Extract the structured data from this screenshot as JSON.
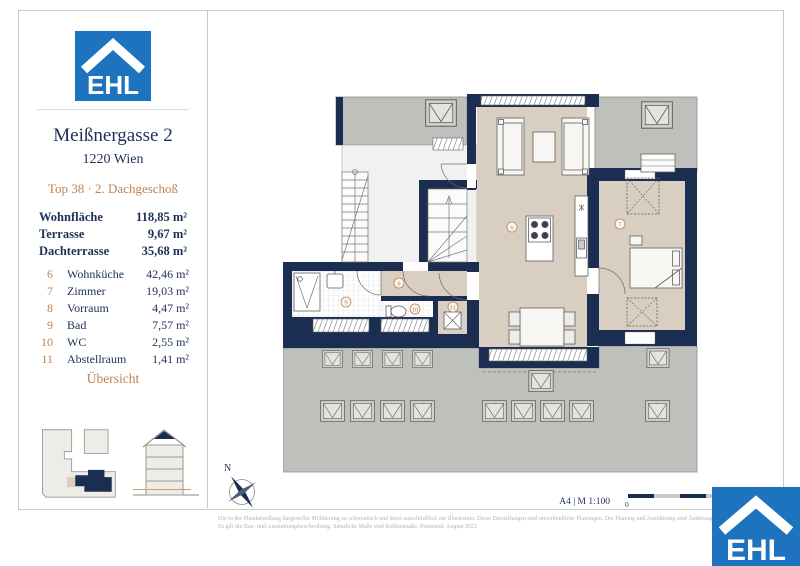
{
  "brand": {
    "name": "EHL",
    "blue": "#1e73be"
  },
  "sidebar": {
    "address_line1": "Meißnergasse 2",
    "address_line2": "1220 Wien",
    "unit_line": "Top 38 · 2. Dachgeschoß",
    "areas": [
      {
        "label": "Wohnfläche",
        "value": "118,85 m²"
      },
      {
        "label": "Terrasse",
        "value": "9,67 m²"
      },
      {
        "label": "Dachterrasse",
        "value": "35,68 m²"
      }
    ],
    "overview_title": "Übersicht"
  },
  "rooms": [
    {
      "no": "6",
      "name": "Wohnküche",
      "area": "42,46 m²"
    },
    {
      "no": "7",
      "name": "Zimmer",
      "area": "19,03 m²"
    },
    {
      "no": "8",
      "name": "Vorraum",
      "area": "4,47 m²"
    },
    {
      "no": "9",
      "name": "Bad",
      "area": "7,57 m²"
    },
    {
      "no": "10",
      "name": "WC",
      "area": "2,55 m²"
    },
    {
      "no": "11",
      "name": "Abstellraum",
      "area": "1,41 m²"
    }
  ],
  "footer": {
    "compass_label": "N",
    "format_scale": "A4 | M 1:100",
    "scale_zero": "0",
    "disclaimer_line1": "Die in der Plandarstellung dargestellte Möblierung ist schematisch und dient ausschließlich zur Illustration. Diese Darstellungen sind unverbindliche Planungen. Der Planung und Ausführung sind Änderungen vorbehalten.",
    "disclaimer_line2": "Es gilt die Bau- und Ausstattungsbeschreibung. Sämtliche Maße sind Rohbaumaße. Planstand: August 2022"
  },
  "colors": {
    "wall": "#1b2d50",
    "accent": "#bf8150",
    "floor": "#d8cfc2",
    "terrace": "#bdc0bb",
    "text": "#1d3156"
  }
}
